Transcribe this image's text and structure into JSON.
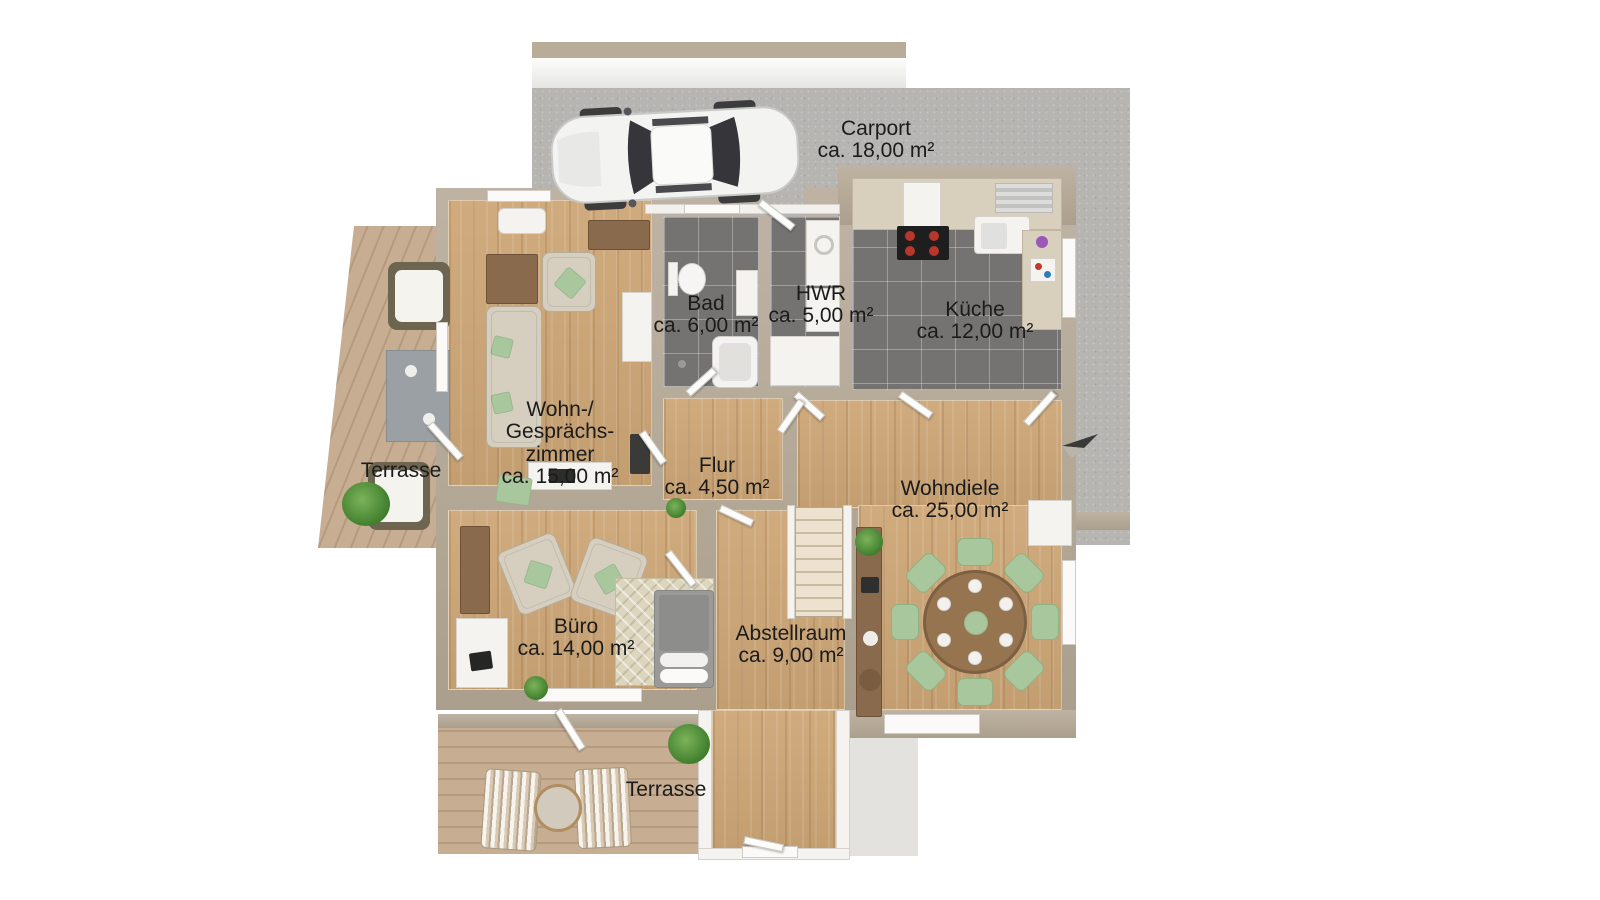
{
  "colors": {
    "wall": "#b4a794",
    "concrete": "#b7b5b2",
    "wood_floor": "#cda677",
    "tile_floor": "#757371",
    "terrace_wood": "#c7ae93",
    "chair_green": "#a9c79c",
    "table_brown": "#96744f",
    "sofa_beige": "#d6cfc0",
    "cabinet_brown": "#8a6a4c",
    "label_text": "#1b1b1b"
  },
  "rooms": {
    "carport": {
      "name": "Carport",
      "area": "ca. 18,00 m²"
    },
    "bad": {
      "name": "Bad",
      "area": "ca. 6,00 m²"
    },
    "hwr": {
      "name": "HWR",
      "area": "ca. 5,00 m²"
    },
    "kueche": {
      "name": "Küche",
      "area": "ca. 12,00 m²"
    },
    "wohnzimmer": {
      "name": "Wohn-/\nGesprächs-\nzimmer",
      "area": "ca. 15,00 m²"
    },
    "flur": {
      "name": "Flur",
      "area": "ca. 4,50 m²"
    },
    "wohndiele": {
      "name": "Wohndiele",
      "area": "ca. 25,00 m²"
    },
    "buero": {
      "name": "Büro",
      "area": "ca. 14,00 m²"
    },
    "abstellraum": {
      "name": "Abstellraum",
      "area": "ca. 9,00 m²"
    },
    "terrasse_links": {
      "name": "Terrasse"
    },
    "terrasse_unten": {
      "name": "Terrasse"
    }
  }
}
